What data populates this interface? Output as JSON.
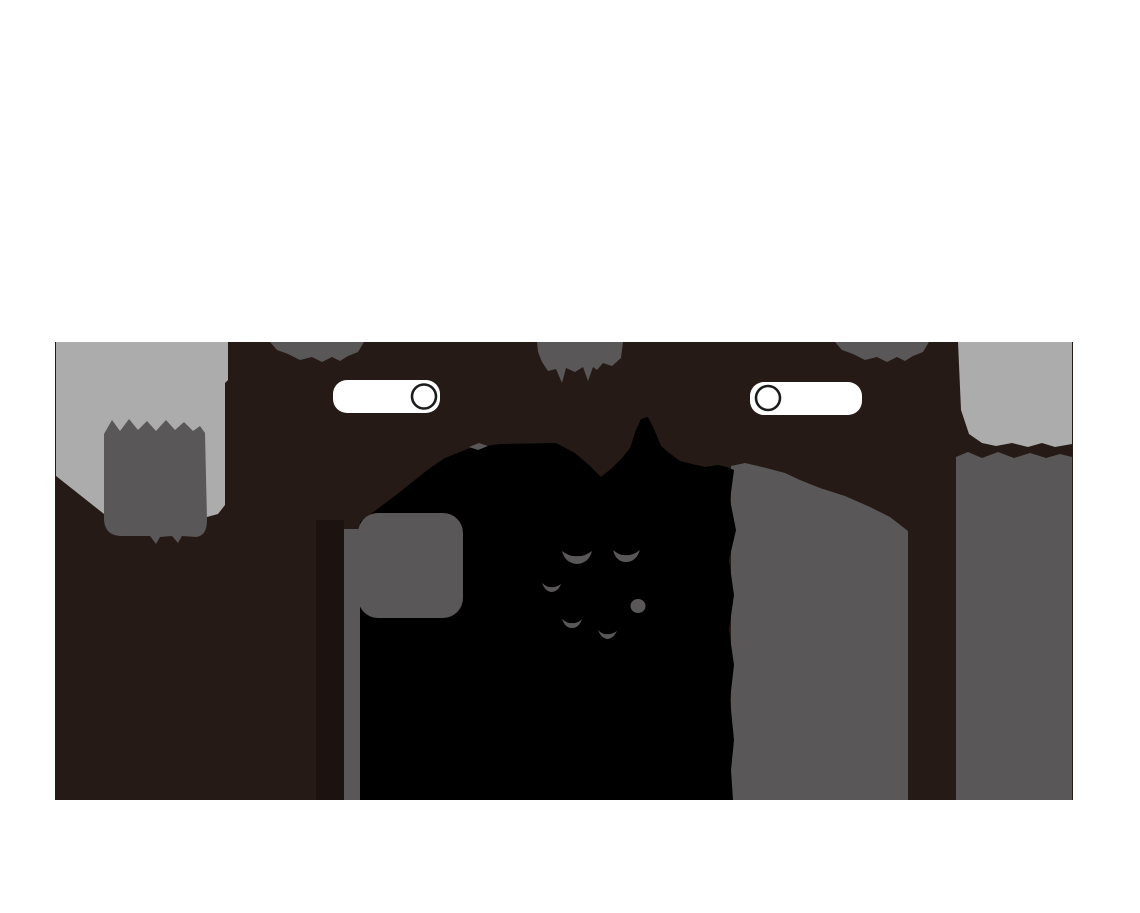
{
  "colors": {
    "page_background": "#ffffff",
    "panel_background": "#251a16",
    "panel_shadow_band": "#1c1310",
    "black": "#000000",
    "gray": "#595757",
    "light_gray": "#acacad",
    "toggle_fill": "#ffffff",
    "toggle_ring": "#1c1c1c"
  },
  "panel": {
    "toggle_count": 2,
    "toggles": [
      {
        "id": "toggle-left",
        "knob_side": "right"
      },
      {
        "id": "toggle-right",
        "knob_side": "left"
      }
    ],
    "crescent_mark_count": 6
  }
}
